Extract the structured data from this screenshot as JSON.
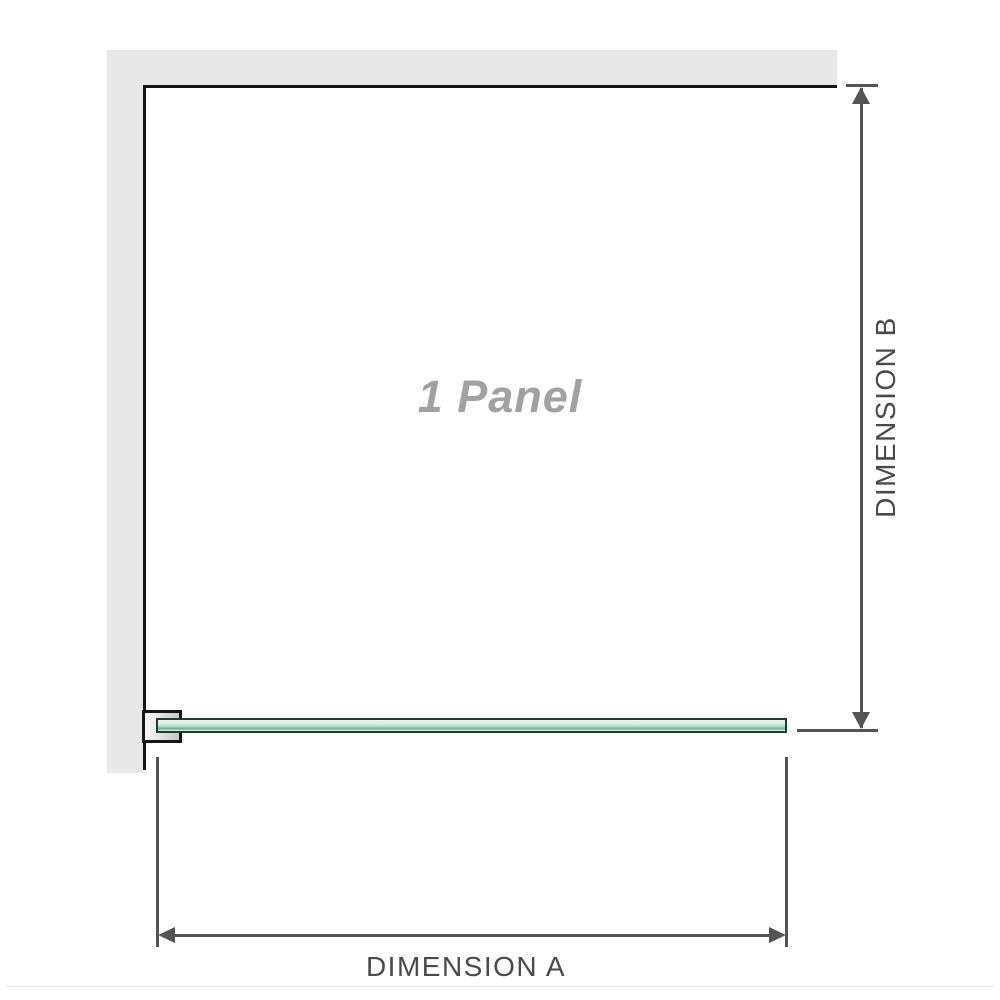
{
  "diagram": {
    "panel_label": "1 Panel",
    "dimensions": {
      "a_label": "DIMENSION A",
      "b_label": "DIMENSION B"
    }
  },
  "colors": {
    "background": "#ffffff",
    "wall_fill": "#e7e7e7",
    "outline": "#161616",
    "dimension_line": "#545454",
    "dimension_text": "#4a4a4a",
    "panel_label_text": "#a1a1a1",
    "glass_border": "#223b2d",
    "glass_light": "#e9f8f0",
    "glass_mid": "#b9e3cf",
    "glass_dark": "#6fa88d",
    "bracket_fill_light": "#f8f8f8",
    "bracket_fill_dark": "#c8c8c8",
    "footer_rule": "#e8e5e0"
  }
}
